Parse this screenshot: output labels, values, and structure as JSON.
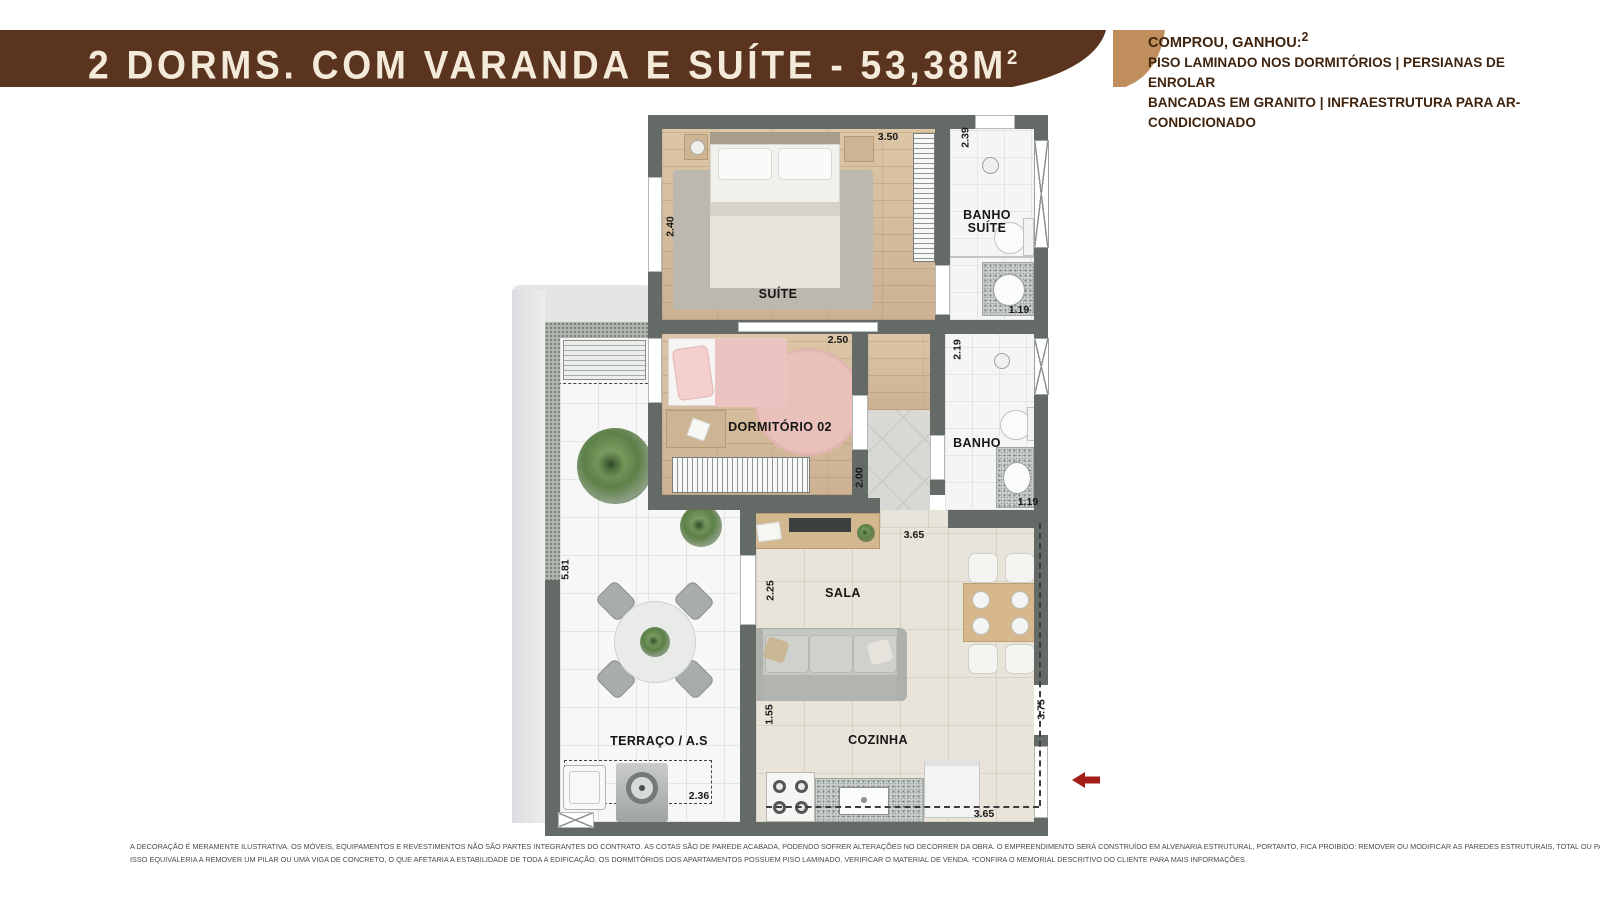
{
  "banner": {
    "title": "2 DORMS. COM VARANDA E SUÍTE - 53,38M",
    "title_sup": "2",
    "colors": {
      "dark_brown": "#5a341f",
      "tan": "#bf8e5c",
      "text": "#f3ead9"
    }
  },
  "promo": {
    "heading": "COMPROU, GANHOU:",
    "heading_sup": "2",
    "lines": [
      "PISO LAMINADO NOS DORMITÓRIOS  |  PERSIANAS DE ENROLAR",
      "BANCADAS EM GRANITO  |  INFRAESTRUTURA PARA AR-CONDICIONADO"
    ],
    "text_color": "#40230d"
  },
  "plan": {
    "labels": {
      "suite": "SUÍTE",
      "banho_suite_line1": "BANHO",
      "banho_suite_line2": "SUÍTE",
      "dormitorio02": "DORMITÓRIO 02",
      "banho": "BANHO",
      "sala": "SALA",
      "cozinha": "COZINHA",
      "terraco": "TERRAÇO / A.S"
    },
    "dimensions": {
      "suite_width": "3.50",
      "suite_depth": "2.40",
      "banho_suite_depth": "2.39",
      "banho_suite_width": "1.19",
      "dorm2_width": "2.50",
      "dorm2_depth": "2.00",
      "banho_depth": "2.19",
      "banho_width": "1.19",
      "sala_width": "3.65",
      "sala_depth": "2.25",
      "terraco_depth": "5.81",
      "cozinha_depth": "1.55",
      "entry_wall_depth": "3.75",
      "service_width": "2.36",
      "cozinha_width": "3.65"
    },
    "entry_arrow_color": "#a61c18",
    "wall_color": "#646b67"
  },
  "footer": {
    "line1": "A DECORAÇÃO É MERAMENTE ILUSTRATIVA. OS MÓVEIS, EQUIPAMENTOS E REVESTIMENTOS NÃO SÃO PARTES INTEGRANTES DO CONTRATO. AS COTAS SÃO DE PAREDE ACABADA, PODENDO SOFRER ALTERAÇÕES NO DECORRER DA OBRA. O EMPREENDIMENTO SERÁ CONSTRUÍDO EM ALVENARIA ESTRUTURAL, PORTANTO, FICA PROIBIDO: REMOVER OU MODIFICAR AS PAREDES ESTRUTURAIS, TOTAL OU PARCIALMENTE, ABRIR VÃOS OU RASGOS, AINDA QUE PEQUENOS, PARA QUALQUER INSTALAÇÃO, OU PERMITIR QUE TERCEIROS O FAÇAM.",
    "line2": "ISSO EQUIVALERIA A REMOVER UM PILAR OU UMA VIGA DE CONCRETO, O QUE AFETARIA A ESTABILIDADE DE TODA A EDIFICAÇÃO. OS DORMITÓRIOS DOS APARTAMENTOS POSSUEM PISO LAMINADO. VERIFICAR O MATERIAL DE VENDA. ²CONFIRA O MEMORIAL DESCRITIVO DO CLIENTE PARA MAIS INFORMAÇÕES."
  }
}
